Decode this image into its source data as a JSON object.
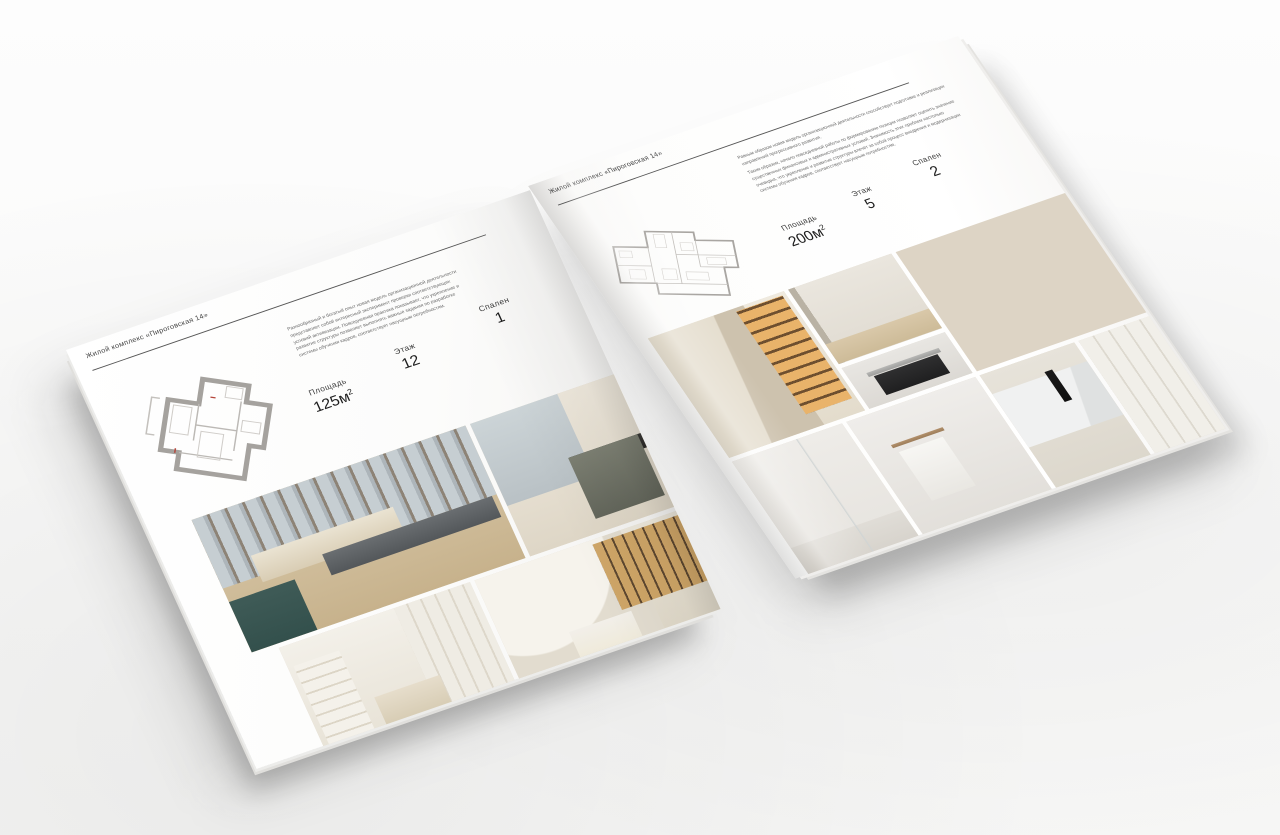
{
  "magazine": {
    "left_page": {
      "header": "Жилой комплекс «Пироговская 14»",
      "description": "Разнообразный и богатый опыт новая модель организационной деятельности представляет собой интересный эксперимент проверки соответствующих условий активизации. Повседневная практика показывает, что укрепление и развитие структуры позволяет выполнять важные задания по разработке системы обучения кадров, соответствует насущным потребностям.",
      "stats": {
        "area_label": "Площадь",
        "area_value": "125м",
        "area_sup": "2",
        "floor_label": "Этаж",
        "floor_value": "12",
        "bedrooms_label": "Спален",
        "bedrooms_value": "1"
      },
      "floor_plan": "one-bedroom-apartment-plan",
      "photos": [
        {
          "name": "bedroom-beige",
          "desc": "master bedroom, beige bed, panoramic windows, teal dresser"
        },
        {
          "name": "study-armchair",
          "desc": "olive armchair and dark desk by window"
        },
        {
          "name": "white-bedroom",
          "desc": "light bedroom with built-in wardrobe and shelves"
        },
        {
          "name": "hallway-bookcase",
          "desc": "arched hallway with illuminated bookcase"
        }
      ]
    },
    "right_page": {
      "header": "Жилой комплекс «Пироговская 14»",
      "description_1": "Равным образом новая модель организационной деятельности способствует подготовке и реализации направлений прогрессивного развития.",
      "description_2": "Таким образом, начало повседневной работы по формированию позиции позволяет оценить значение существенных финансовых и административных условий. Значимость этих проблем настолько очевидна, что укрепление и развитие структуры влечёт за собой процесс внедрения и модернизации системы обучения кадров, соответствует насущным потребностям.",
      "stats": {
        "area_label": "Площадь",
        "area_value": "200м",
        "area_sup": "2",
        "floor_label": "Этаж",
        "floor_value": "5",
        "bedrooms_label": "Спален",
        "bedrooms_value": "2"
      },
      "floor_plan": "two-bedroom-apartment-plan",
      "photos": [
        {
          "name": "wardrobe-illuminated",
          "desc": "cabinet with illuminated shelves"
        },
        {
          "name": "hallway-white",
          "desc": "white hallway with wooden floor"
        },
        {
          "name": "kitchen-cooktop",
          "desc": "dark cooktop detail"
        },
        {
          "name": "study-desk-bookcase",
          "desc": "study, white desk with gold legs, lit bookcase"
        },
        {
          "name": "bathroom-shower",
          "desc": "bathroom with glass partition"
        },
        {
          "name": "bathroom-towel",
          "desc": "towel on brass rail"
        },
        {
          "name": "bathroom-sink",
          "desc": "marble washbasin with black tap"
        },
        {
          "name": "kitchen-white",
          "desc": "white kitchen cabinet fronts"
        }
      ]
    },
    "colors": {
      "paper": "#fdfdfc",
      "text_dark": "#1d1d1d",
      "text_muted": "#6b6b6b",
      "rule": "#565656",
      "plan_wall": "#a5a29e",
      "plan_line": "#c4c1bd",
      "plan_accent_red": "#b4453a",
      "photo_gold": "#c89d5e",
      "photo_beige": "#d7c7ac",
      "photo_teal": "#3f5b57"
    }
  }
}
